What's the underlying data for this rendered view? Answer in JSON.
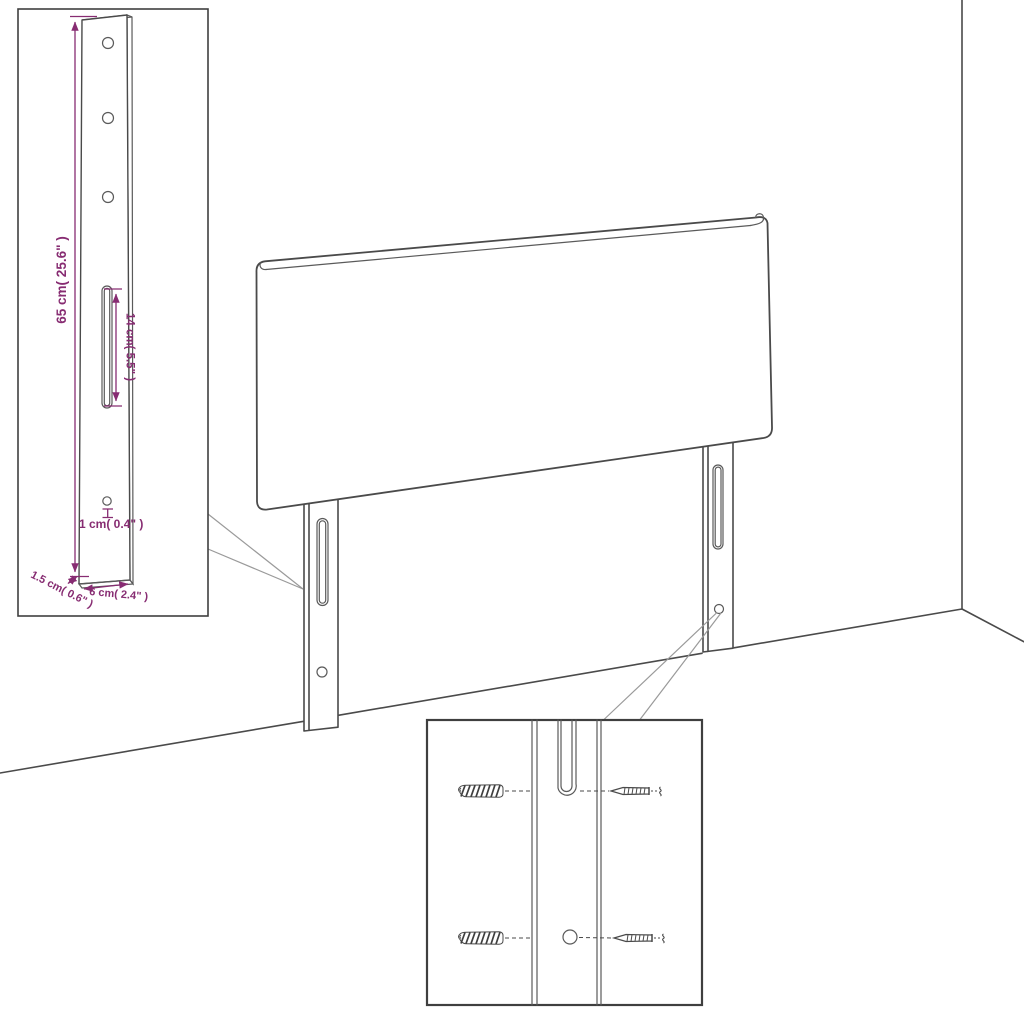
{
  "illustration": {
    "title": "headboard with mounting legs - dimension diagram",
    "colors": {
      "outline": "#4a4a4a",
      "leader": "#9a9a9a",
      "dimension": "#872c72",
      "background": "#ffffff"
    },
    "detail_inset": {
      "labels": {
        "height": "65 cm( 25.6\" )",
        "slot_length": "14 cm( 5.5\" )",
        "hole_diameter": "1 cm( 0.4\" )",
        "thickness": "1.5 cm( 0.6\" )",
        "width": "6 cm( 2.4\" )"
      }
    }
  }
}
